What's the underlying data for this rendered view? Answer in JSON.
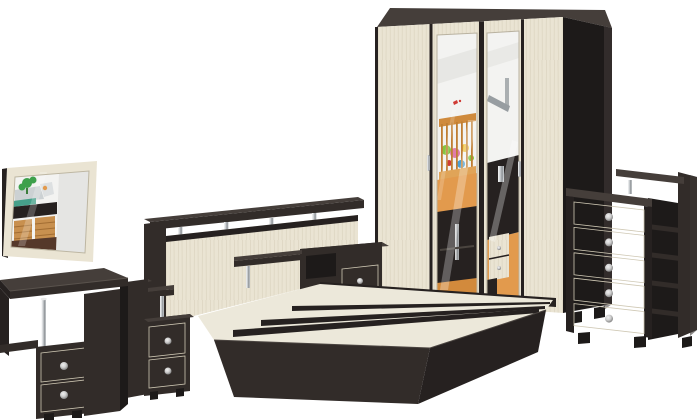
{
  "window": {
    "width": 700,
    "height": 420,
    "background": "#ffffff"
  },
  "scene": {
    "description": "Product photo of a two-tone bedroom furniture set (dark wenge and light birch) on a white background",
    "items": [
      {
        "id": "wall-mirror",
        "label": "Wall mirror"
      },
      {
        "id": "dressing-table",
        "label": "Dressing table with two drawers"
      },
      {
        "id": "nightstand-left",
        "label": "Left bedside nightstand"
      },
      {
        "id": "bed",
        "label": "Double bed with headboard shelf and slats"
      },
      {
        "id": "nightstand-right",
        "label": "Right bedside nightstand"
      },
      {
        "id": "wardrobe",
        "label": "Four-door wardrobe with two mirror doors"
      },
      {
        "id": "chest",
        "label": "Chest of five drawers with side shelves"
      }
    ]
  },
  "palette": {
    "bg": "#ffffff",
    "wenge": "#322c29",
    "wenge_top": "#453e3a",
    "wenge_dark": "#262120",
    "wenge_deep": "#1d1a19",
    "cream": "#eae4d3",
    "cream_shade": "#cfc8b4",
    "grain_line": "#ddd6c2",
    "slat": "#ece8da",
    "mirror_grey": "#e5e5e3",
    "white_wall": "#f3f3f1",
    "chrome_light": "#f5f5f5",
    "chrome_mid": "#cdd1d4",
    "chrome_dark": "#8e9296",
    "knob_light": "#f0f0f0",
    "knob_dark": "#6a6a6a",
    "floor_orange": "#e29a4d",
    "crib_wood": "#cf8a3c",
    "basket": "#c8904f",
    "floor_brown": "#55382a",
    "plant_green": "#3da04b",
    "toy_green": "#86c440",
    "toy_pink": "#e07cab",
    "toy_red": "#cf3b35",
    "toy_blue": "#4a9fd4",
    "toy_yellow": "#eec23f",
    "lamp_grey": "#979da1",
    "teal": "#46a08a"
  }
}
